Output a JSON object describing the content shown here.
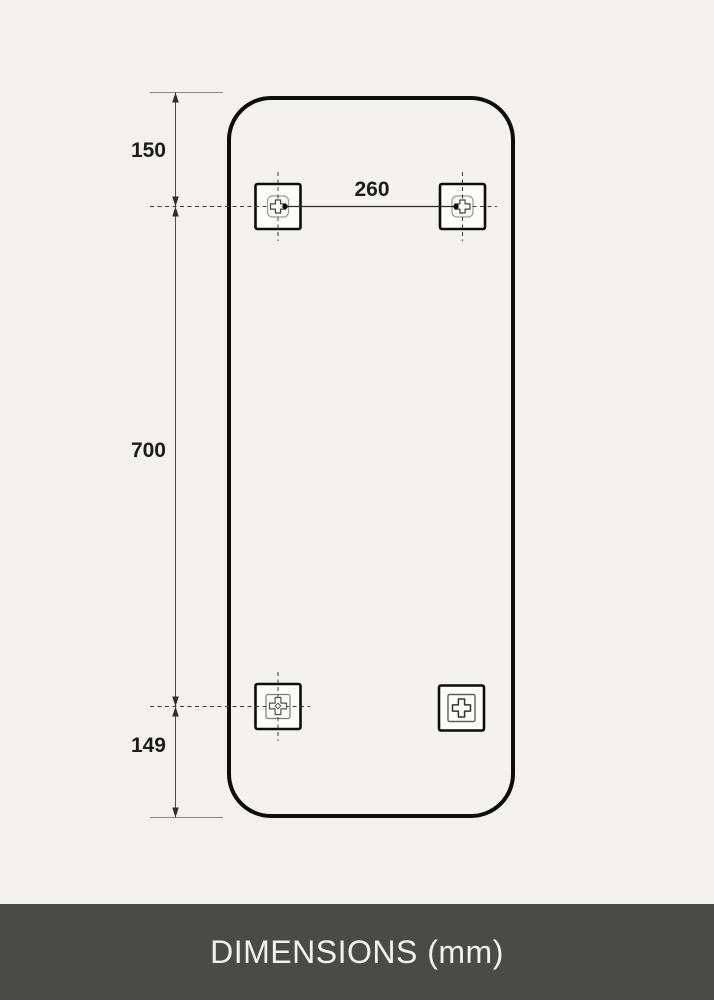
{
  "page": {
    "background_color": "#f2f1ee"
  },
  "footer": {
    "title": "DIMENSIONS (mm)",
    "background_color": "#4a4a48",
    "text_color": "#f1f1f0"
  },
  "diagram": {
    "type": "technical-dimension-drawing",
    "unit": "mm",
    "dimensions": {
      "top_edge_to_top_holes": "150",
      "top_holes_horizontal_spacing": "260",
      "top_holes_to_bottom_holes": "700",
      "bottom_holes_to_bottom_edge": "149"
    },
    "panel": {
      "outline_color": "#0d0d0d",
      "fill_color": "#f3f2ef",
      "corner_style": "rounded"
    },
    "line_color": "#3c3c3c",
    "brackets": [
      {
        "position": "top-left",
        "glyph": "keyhole-cross-with-right-dot",
        "crosshair": true
      },
      {
        "position": "top-right",
        "glyph": "keyhole-cross-with-left-dot",
        "crosshair": true
      },
      {
        "position": "bottom-left",
        "glyph": "cross-with-diamond-hole",
        "crosshair": true
      },
      {
        "position": "bottom-right",
        "glyph": "plain-cross",
        "crosshair": false
      }
    ]
  }
}
